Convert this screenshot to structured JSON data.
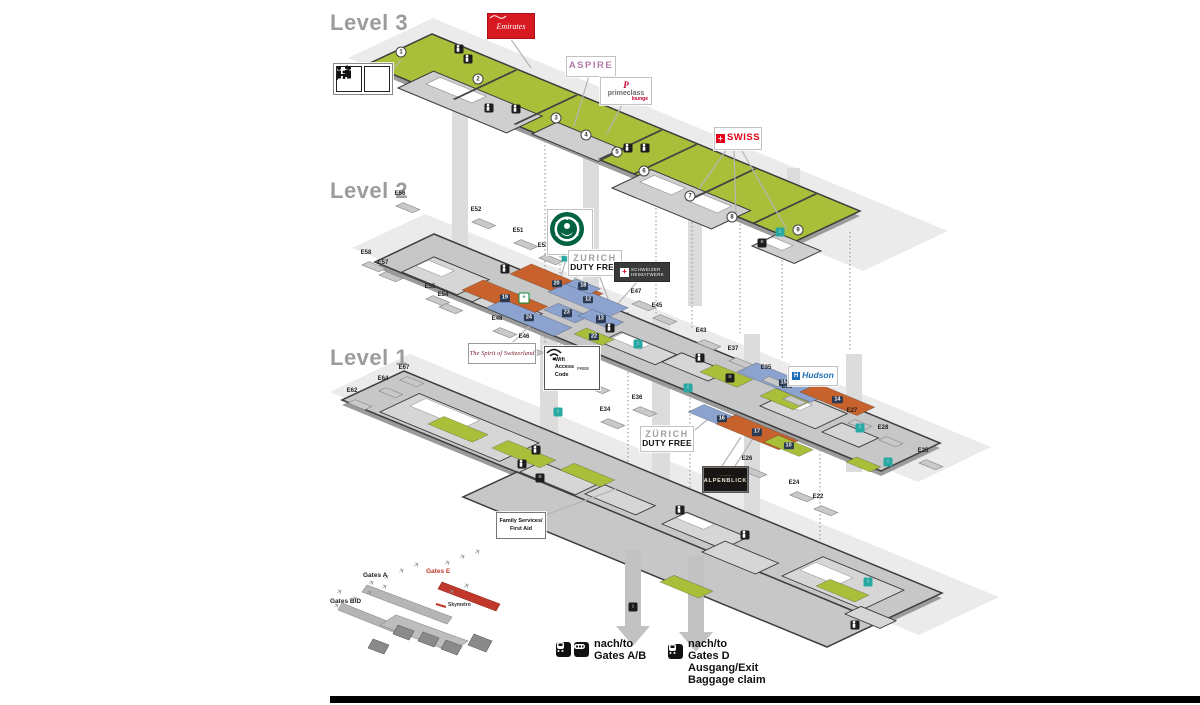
{
  "colors": {
    "floor_green": "#a9bf3a",
    "floor_gray": "#c7c7c7",
    "slab": "#e9e9e9",
    "wall": "#3d3d3d",
    "zone_orange": "#c8622d",
    "zone_blue": "#8ca3cf",
    "zone_green": "#a9bf3a",
    "teal": "#29a8a2",
    "emirates_red": "#d71921",
    "swiss_red": "#e2001a",
    "hudson_blue": "#1d6fb8",
    "minimap_red": "#c0392b",
    "level_label_gray": "#9c9c9c",
    "starbucks_green": "#006241",
    "footer_bar": "#000000"
  },
  "levels": {
    "l3": {
      "label": "Level 3"
    },
    "l2": {
      "label": "Level 2"
    },
    "l1": {
      "label": "Level 1"
    }
  },
  "signs": {
    "emirates": {
      "text": "Emirates"
    },
    "aspire": {
      "text": "ASPIRE"
    },
    "primeclass": {
      "initial": "P",
      "name": "primeclass",
      "sub": "lounge"
    },
    "swiss": {
      "text": "SWISS",
      "cross": "+"
    },
    "starbucks": {
      "icon": "starbucks-siren-logo"
    },
    "zurich_duty_free_l2": {
      "line1": "ZURICH",
      "line2": "DUTY FREE"
    },
    "swiss_shop": {
      "cross": "+",
      "line1": "SCHWEIZER",
      "line2": "HEIMATWERK"
    },
    "spirit": {
      "text": "The Spirit of Switzerland"
    },
    "wifi": {
      "line1": "Wifi",
      "line2": "Access",
      "line3": "Code",
      "badge": "FREE"
    },
    "hudson": {
      "initial": "H",
      "text": "Hudson"
    },
    "zurich_duty_free_l1": {
      "line1": "ZÜRICH",
      "line2": "DUTY FREE"
    },
    "alpenblick": {
      "text": "ALPENBLICK",
      "decor": "~~~~~"
    },
    "family": {
      "line1": "Family Services/",
      "line2": "First Aid"
    }
  },
  "minimap": {
    "gates_a": "Gates A",
    "gates_bd": "Gates B/D",
    "gates_e": "Gates E",
    "skymetro": "Skymetro"
  },
  "footer": {
    "dest1": {
      "line1": "nach/to",
      "line2": "Gates A/B"
    },
    "dest2": {
      "line1": "nach/to",
      "line2": "Gates D",
      "line3": "Ausgang/Exit",
      "line4": "Baggage claim"
    }
  },
  "map": {
    "zone_badges_l3": [
      {
        "n": "1",
        "x": 401,
        "y": 52
      },
      {
        "n": "2",
        "x": 478,
        "y": 79
      },
      {
        "n": "3",
        "x": 556,
        "y": 118
      },
      {
        "n": "4",
        "x": 586,
        "y": 135
      },
      {
        "n": "5",
        "x": 617,
        "y": 152
      },
      {
        "n": "6",
        "x": 644,
        "y": 171
      },
      {
        "n": "7",
        "x": 690,
        "y": 196
      },
      {
        "n": "8",
        "x": 732,
        "y": 217
      },
      {
        "n": "9",
        "x": 798,
        "y": 230
      }
    ],
    "gates_l2": [
      {
        "t": "E56",
        "x": 400,
        "y": 194
      },
      {
        "t": "E52",
        "x": 476,
        "y": 210
      },
      {
        "t": "E51",
        "x": 518,
        "y": 231
      },
      {
        "t": "E53",
        "x": 543,
        "y": 246
      },
      {
        "t": "E47",
        "x": 636,
        "y": 292
      },
      {
        "t": "E45",
        "x": 657,
        "y": 306
      },
      {
        "t": "E43",
        "x": 701,
        "y": 331
      },
      {
        "t": "E58",
        "x": 366,
        "y": 253
      },
      {
        "t": "E57",
        "x": 383,
        "y": 263
      },
      {
        "t": "E55",
        "x": 430,
        "y": 287
      },
      {
        "t": "E54",
        "x": 443,
        "y": 295
      },
      {
        "t": "E48",
        "x": 497,
        "y": 319
      },
      {
        "t": "E46",
        "x": 524,
        "y": 337
      },
      {
        "t": "E44",
        "x": 576,
        "y": 364
      },
      {
        "t": "E42",
        "x": 590,
        "y": 375
      },
      {
        "t": "E37",
        "x": 733,
        "y": 349
      },
      {
        "t": "E35",
        "x": 766,
        "y": 368
      },
      {
        "t": "E33",
        "x": 787,
        "y": 387
      },
      {
        "t": "E27",
        "x": 852,
        "y": 411
      },
      {
        "t": "E28",
        "x": 883,
        "y": 428
      },
      {
        "t": "E25",
        "x": 923,
        "y": 451
      }
    ],
    "gates_l1": [
      {
        "t": "E67",
        "x": 404,
        "y": 368
      },
      {
        "t": "E64",
        "x": 383,
        "y": 379
      },
      {
        "t": "E62",
        "x": 352,
        "y": 391
      },
      {
        "t": "E36",
        "x": 637,
        "y": 398
      },
      {
        "t": "E34",
        "x": 605,
        "y": 410
      },
      {
        "t": "E26",
        "x": 747,
        "y": 459
      },
      {
        "t": "E24",
        "x": 794,
        "y": 483
      },
      {
        "t": "E22",
        "x": 818,
        "y": 497
      }
    ],
    "shop_zones_l2": [
      {
        "n": "19",
        "c": "orange",
        "x": 462,
        "y": 290,
        "u": 70,
        "v": 24
      },
      {
        "n": "20",
        "c": "orange",
        "x": 510,
        "y": 274,
        "u": 78,
        "v": 24
      },
      {
        "n": "12",
        "c": "blue",
        "x": 548,
        "y": 292,
        "u": 66,
        "v": 22
      },
      {
        "n": "24",
        "c": "blue",
        "x": 486,
        "y": 308,
        "u": 74,
        "v": 20
      },
      {
        "n": "23",
        "c": "blue",
        "x": 544,
        "y": 310,
        "u": 34,
        "v": 16
      },
      {
        "n": "13",
        "c": "blue",
        "x": 578,
        "y": 316,
        "u": 34,
        "v": 16
      },
      {
        "n": "22",
        "c": "green",
        "x": 574,
        "y": 334,
        "u": 30,
        "v": 14
      },
      {
        "n": "18",
        "c": "blue",
        "x": 566,
        "y": 284,
        "u": 26,
        "v": 12
      },
      {
        "n": "",
        "c": "green",
        "x": 700,
        "y": 372,
        "u": 40,
        "v": 18
      },
      {
        "n": "",
        "c": "green",
        "x": 760,
        "y": 396,
        "u": 36,
        "v": 18
      }
    ],
    "shop_zones_l1": [
      {
        "n": "15",
        "c": "blue",
        "x": 737,
        "y": 372,
        "u": 80,
        "v": 22
      },
      {
        "n": "14",
        "c": "orange",
        "x": 800,
        "y": 392,
        "u": 62,
        "v": 20
      },
      {
        "n": "16",
        "c": "blue",
        "x": 688,
        "y": 412,
        "u": 56,
        "v": 18
      },
      {
        "n": "17",
        "c": "orange",
        "x": 716,
        "y": 424,
        "u": 68,
        "v": 22
      },
      {
        "n": "10",
        "c": "green",
        "x": 764,
        "y": 442,
        "u": 38,
        "v": 16
      },
      {
        "n": "",
        "c": "green",
        "x": 428,
        "y": 424,
        "u": 48,
        "v": 18
      },
      {
        "n": "",
        "c": "green",
        "x": 492,
        "y": 448,
        "u": 52,
        "v": 18
      },
      {
        "n": "",
        "c": "green",
        "x": 560,
        "y": 470,
        "u": 44,
        "v": 16
      },
      {
        "n": "",
        "c": "green",
        "x": 660,
        "y": 582,
        "u": 42,
        "v": 16
      },
      {
        "n": "",
        "c": "green",
        "x": 816,
        "y": 586,
        "u": 42,
        "v": 16
      },
      {
        "n": "",
        "c": "green",
        "x": 846,
        "y": 462,
        "u": 26,
        "v": 12
      }
    ],
    "icons": [
      {
        "t": "wc",
        "x": 459,
        "y": 49
      },
      {
        "t": "wc",
        "x": 468,
        "y": 59
      },
      {
        "t": "wc",
        "x": 489,
        "y": 108
      },
      {
        "t": "wc",
        "x": 516,
        "y": 109
      },
      {
        "t": "wc",
        "x": 628,
        "y": 148
      },
      {
        "t": "wc",
        "x": 645,
        "y": 148
      },
      {
        "t": "stairs",
        "x": 762,
        "y": 243
      },
      {
        "t": "lift",
        "x": 780,
        "y": 232
      },
      {
        "t": "info",
        "x": 566,
        "y": 257
      },
      {
        "t": "lift",
        "x": 638,
        "y": 344
      },
      {
        "t": "wc",
        "x": 505,
        "y": 269
      },
      {
        "t": "wc",
        "x": 610,
        "y": 328
      },
      {
        "t": "wc",
        "x": 700,
        "y": 358
      },
      {
        "t": "stairs",
        "x": 730,
        "y": 378
      },
      {
        "t": "cross",
        "x": 524,
        "y": 298
      },
      {
        "t": "info",
        "x": 860,
        "y": 428
      },
      {
        "t": "lift",
        "x": 558,
        "y": 412
      },
      {
        "t": "wc",
        "x": 536,
        "y": 450
      },
      {
        "t": "wc",
        "x": 522,
        "y": 464
      },
      {
        "t": "stairs",
        "x": 540,
        "y": 478
      },
      {
        "t": "info",
        "x": 688,
        "y": 388
      },
      {
        "t": "wc",
        "x": 680,
        "y": 510
      },
      {
        "t": "wc",
        "x": 745,
        "y": 535
      },
      {
        "t": "info",
        "x": 868,
        "y": 582
      },
      {
        "t": "wc",
        "x": 855,
        "y": 625
      },
      {
        "t": "lift",
        "x": 888,
        "y": 462
      },
      {
        "t": "liftdark",
        "x": 633,
        "y": 607
      }
    ],
    "planes": [
      {
        "x": 372,
        "y": 583
      },
      {
        "x": 387,
        "y": 577
      },
      {
        "x": 402,
        "y": 571
      },
      {
        "x": 417,
        "y": 565
      },
      {
        "x": 355,
        "y": 599
      },
      {
        "x": 370,
        "y": 593
      },
      {
        "x": 385,
        "y": 587
      },
      {
        "x": 448,
        "y": 563
      },
      {
        "x": 463,
        "y": 557
      },
      {
        "x": 478,
        "y": 552
      },
      {
        "x": 452,
        "y": 592
      },
      {
        "x": 467,
        "y": 586
      },
      {
        "x": 340,
        "y": 592
      },
      {
        "x": 337,
        "y": 606
      }
    ]
  }
}
